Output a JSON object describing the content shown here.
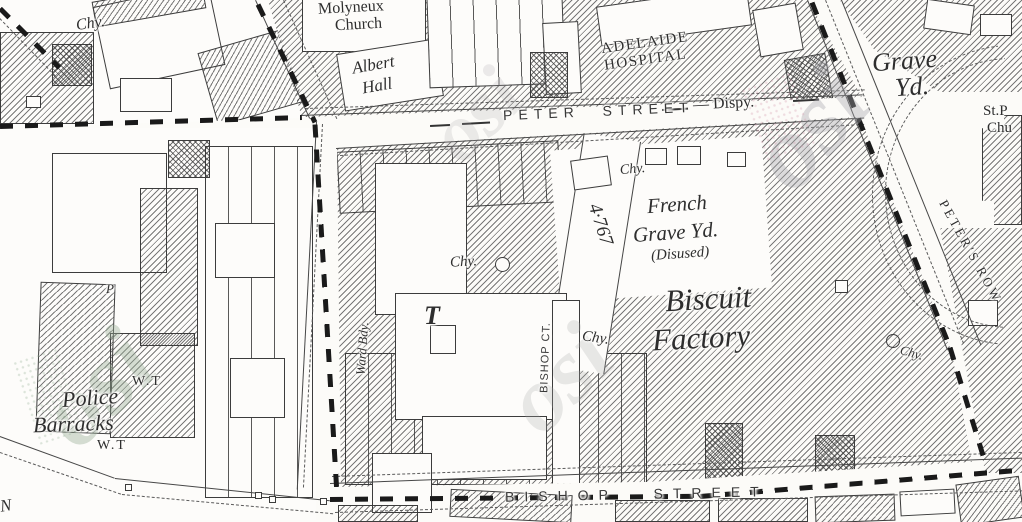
{
  "map": {
    "labels": {
      "chy_topleft": "Chy.",
      "molyneux_line1": "Molyneux",
      "molyneux_line2": "Church",
      "albert_line1": "Albert",
      "albert_line2": "Hall",
      "adelaide_line1": "ADELAIDE",
      "adelaide_line2": "HOSPITAL",
      "peter_street": "PETER STREET",
      "dispy": "— Dispy.",
      "grave_yd_line1": "Grave",
      "grave_yd_line2": "Yd.",
      "st_peters_line1": "St.P",
      "st_peters_line2": "Chu",
      "peters_row": "PETER'S ROW",
      "chy_french": "Chy.",
      "french_line1": "French",
      "french_line2": "Grave Yd.",
      "french_line3": "(Disused)",
      "plot_area": "4·767",
      "biscuit_line1": "Biscuit",
      "biscuit_line2": "Factory",
      "chy_factory": "Chy.",
      "chy_mid": "Chy.",
      "t_mark": "T",
      "ward_bdy": "Ward Bdy.",
      "bishop_ct": "BISHOP CT.",
      "chy_bishop": "Chy.",
      "wt_upper": "W.T",
      "police_line1": "Police",
      "police_line2": "Barracks",
      "wt_lower": "W.T",
      "p_mark": "P",
      "bishop_street": "BISHOP STREET",
      "n_mark": "N"
    },
    "watermarks": {
      "wm1": "osi",
      "wm2": "osi",
      "wm3": "osi",
      "wm4": "osi"
    },
    "colors": {
      "ink": "#3c3c3c",
      "boundary": "#1a1a1a",
      "paper": "#fcfbf8",
      "watermark_gray": "#b9b9bd",
      "watermark_green": "#a9c0a6",
      "watermark_pink": "#dcb2c0"
    }
  }
}
